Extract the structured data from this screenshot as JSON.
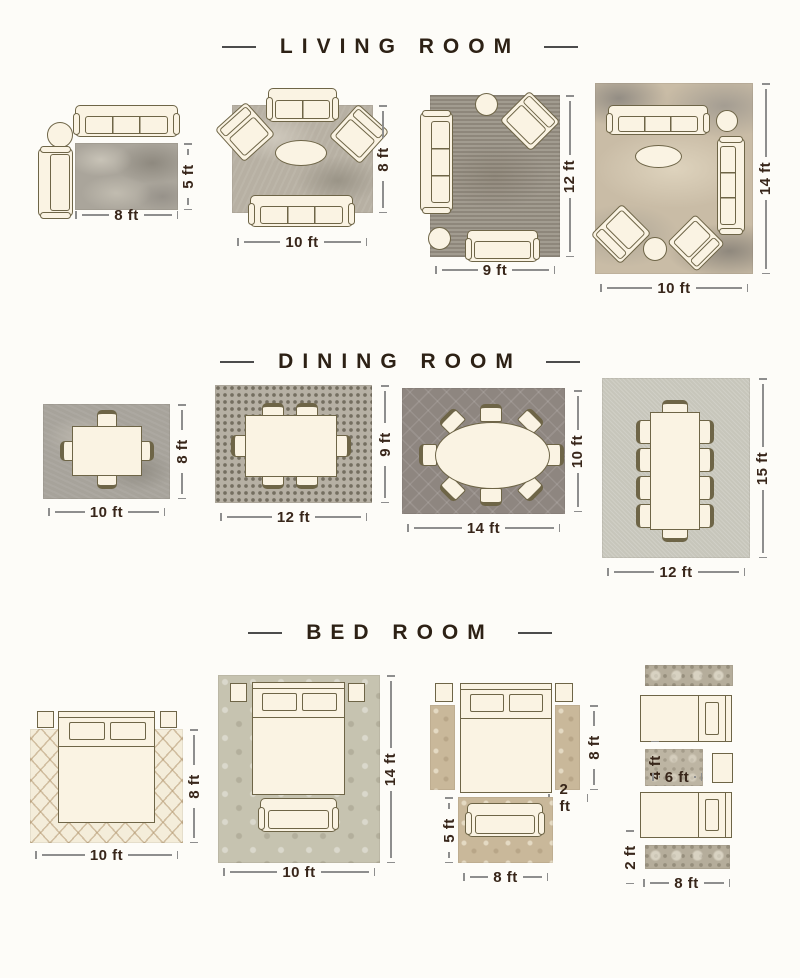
{
  "colors": {
    "background": "#fdfcf8",
    "title_text": "#2d2115",
    "dimension_text": "#38261a",
    "dimension_line": "#8e8e8e",
    "furniture_fill": "#faf3e3",
    "furniture_outline": "#6e6547"
  },
  "sections": [
    {
      "title": "LIVING ROOM",
      "layouts": [
        {
          "rug_size": "8 ft x 5 ft",
          "width_label": "8 ft",
          "height_label": "5 ft",
          "furniture": [
            "3-seat sofa",
            "round side table",
            "chaise lounge"
          ]
        },
        {
          "rug_size": "10 ft x 8 ft",
          "width_label": "10 ft",
          "height_label": "8 ft",
          "furniture": [
            "loveseat",
            "2 angled armchairs",
            "oval coffee table",
            "3-seat sofa"
          ]
        },
        {
          "rug_size": "9 ft x 12 ft",
          "width_label": "9 ft",
          "height_label": "12 ft",
          "furniture": [
            "3-seat sofa",
            "round side table",
            "angled armchair",
            "round ottoman",
            "loveseat"
          ]
        },
        {
          "rug_size": "10 ft x 14 ft",
          "width_label": "10 ft",
          "height_label": "14 ft",
          "furniture": [
            "3-seat sofa",
            "round side table",
            "oval coffee table",
            "3-seat sofa",
            "2 angled armchairs",
            "round ottoman"
          ]
        }
      ]
    },
    {
      "title": "DINING ROOM",
      "layouts": [
        {
          "rug_size": "10 ft x 8 ft",
          "width_label": "10 ft",
          "height_label": "8 ft",
          "furniture": [
            "dining table",
            "4 chairs"
          ]
        },
        {
          "rug_size": "12 ft x 9 ft",
          "width_label": "12 ft",
          "height_label": "9 ft",
          "furniture": [
            "dining table",
            "6 chairs"
          ]
        },
        {
          "rug_size": "14 ft x 10 ft",
          "width_label": "14 ft",
          "height_label": "10 ft",
          "furniture": [
            "oval dining table",
            "8 chairs"
          ]
        },
        {
          "rug_size": "12 ft x 15 ft",
          "width_label": "12 ft",
          "height_label": "15 ft",
          "furniture": [
            "dining table",
            "10 chairs"
          ]
        }
      ]
    },
    {
      "title": "BED ROOM",
      "layouts": [
        {
          "rug_size": "10 ft x 8 ft",
          "width_label": "10 ft",
          "height_label": "8 ft",
          "furniture": [
            "bed",
            "2 nightstands"
          ]
        },
        {
          "rug_size": "10 ft x 14 ft",
          "width_label": "10 ft",
          "height_label": "14 ft",
          "furniture": [
            "bed",
            "2 nightstands",
            "foot bench"
          ]
        },
        {
          "side_runner_length_label": "8 ft",
          "side_runner_width_label": "2 ft",
          "foot_rug_height_label": "5 ft",
          "foot_rug_width_label": "8 ft",
          "furniture": [
            "bed",
            "2 nightstands",
            "2 side runners",
            "loveseat on foot rug"
          ]
        },
        {
          "accent_rug_height_label": "4 ft",
          "accent_rug_width_label": "6 ft",
          "runner_width_label": "2 ft",
          "runner_length_label": "8 ft",
          "furniture": [
            "2 twin beds",
            "nightstand",
            "2 runners",
            "accent rug"
          ]
        }
      ]
    }
  ]
}
